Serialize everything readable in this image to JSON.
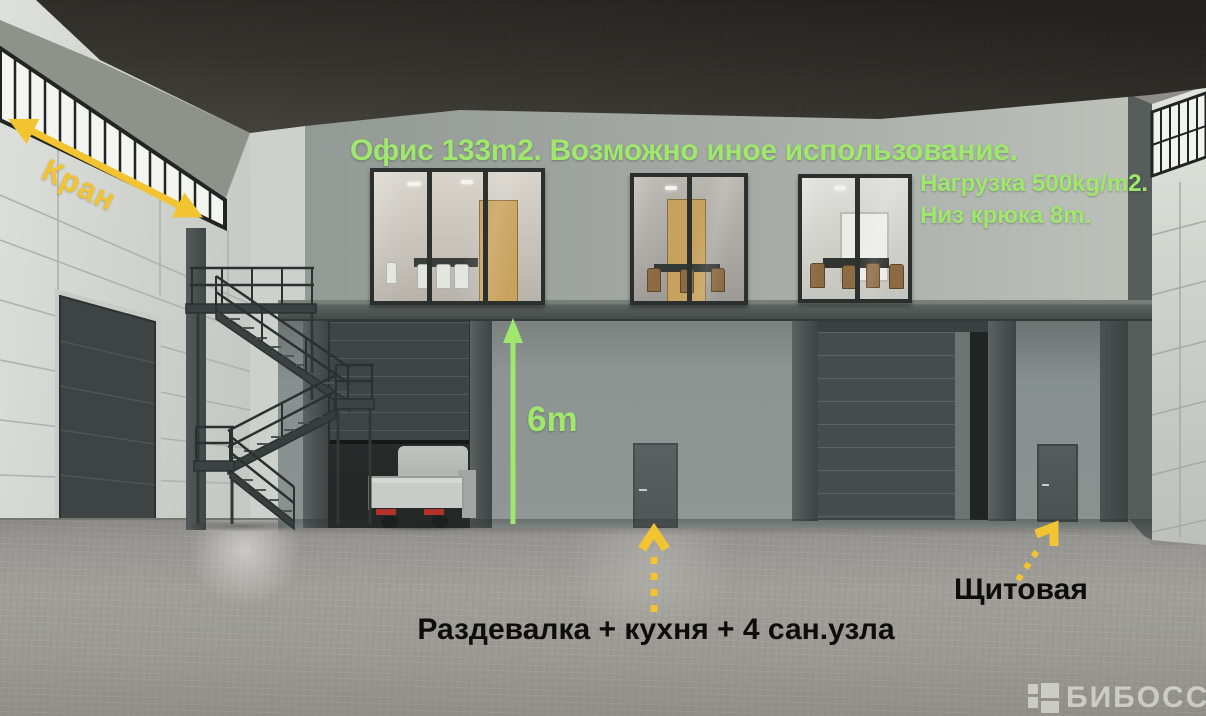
{
  "colors": {
    "green": "#9fe86d",
    "yellow": "#f2c431",
    "ink": "#0d0d0d",
    "watermark": "#eef0ea"
  },
  "annotations": {
    "crane": {
      "label": "Кран"
    },
    "office": {
      "title": "Офис 133m2. Возможно иное использование.",
      "load": "Нагрузка 500kg/m2.",
      "hook": "Низ крюка 8m."
    },
    "height": {
      "label": "6m"
    },
    "rooms": {
      "label": "Раздевалка + кухня + 4 сан.узла"
    },
    "panel_room": {
      "label": "Щитовая"
    }
  },
  "watermark": {
    "label": "БИБОСС"
  }
}
